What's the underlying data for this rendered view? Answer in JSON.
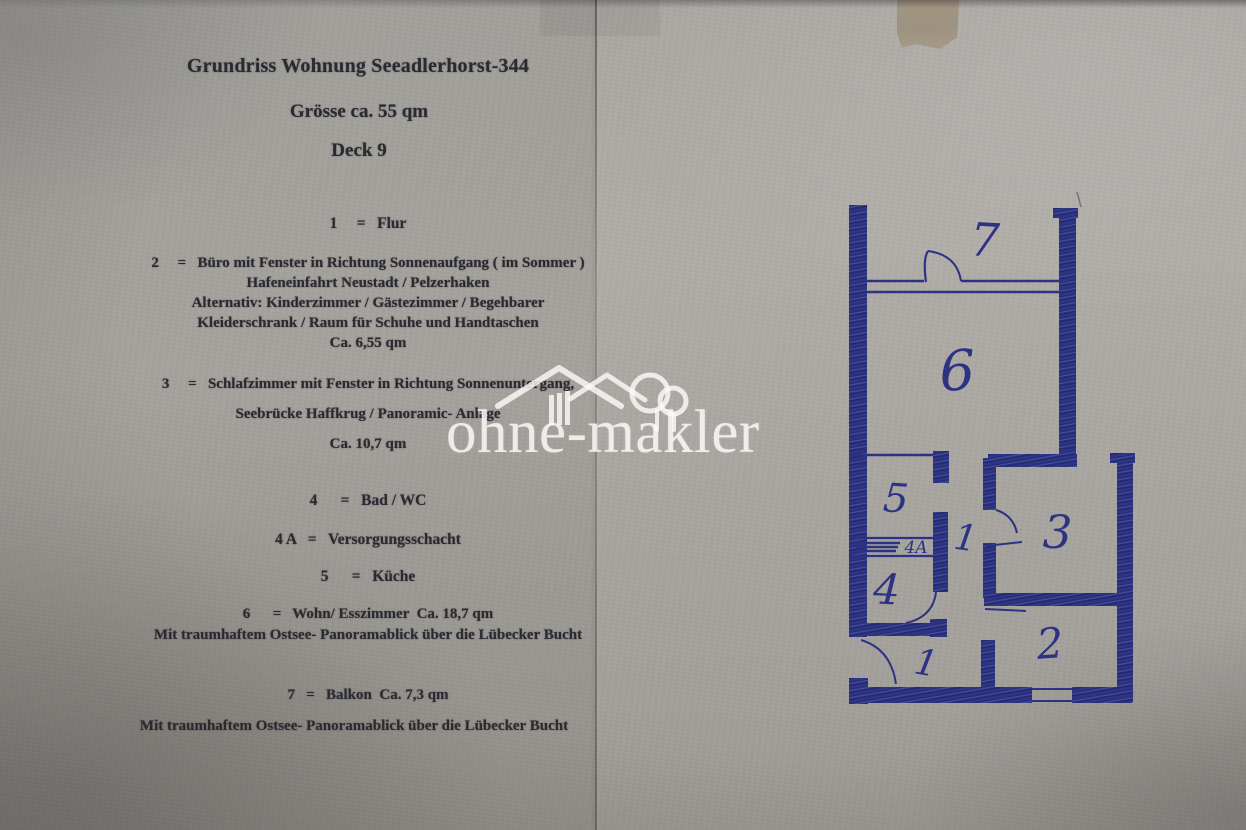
{
  "document": {
    "title": "Grundriss Wohnung Seeadlerhorst-344",
    "size": "Grösse ca. 55 qm",
    "deck": "Deck 9",
    "legend": [
      {
        "lines": [
          "1     =   Flur"
        ]
      },
      {
        "lines": [
          "2     =   Büro mit Fenster in Richtung Sonnenaufgang ( im Sommer )",
          "Hafeneinfahrt Neustadt / Pelzerhaken",
          "Alternativ: Kinderzimmer / Gästezimmer / Begehbarer",
          "Kleiderschrank / Raum für Schuhe und Handtaschen",
          "Ca. 6,55 qm"
        ]
      },
      {
        "lines": [
          "3     =   Schlafzimmer mit Fenster in Richtung Sonnenuntergang,",
          "Seebrücke Haffkrug / Panoramic- Anlage",
          "Ca. 10,7 qm"
        ]
      },
      {
        "lines": [
          "4      =   Bad / WC"
        ]
      },
      {
        "lines": [
          "4 A   =   Versorgungsschacht"
        ]
      },
      {
        "lines": [
          "5      =   Küche"
        ]
      },
      {
        "lines": [
          "6      =   Wohn/ Esszimmer  Ca. 18,7 qm",
          "Mit traumhaftem Ostsee- Panoramablick über die Lübecker Bucht"
        ]
      },
      {
        "lines": [
          "7   =   Balkon  Ca. 7,3 qm",
          "Mit traumhaftem Ostsee- Panoramablick über die Lübecker Bucht"
        ]
      }
    ]
  },
  "watermark": {
    "brand": "ohne-makler"
  },
  "floorplan": {
    "rooms": {
      "balcony": "7",
      "living": "6",
      "kitchen": "5",
      "shaft": "4A",
      "bath": "4",
      "bedroom": "3",
      "office": "2",
      "hall_mid": "1",
      "hall_entry": "1"
    }
  },
  "colors": {
    "ink_blue": "#2c3383",
    "paper_gray": "#a7a49f",
    "watermark_white": "#fbfaf7"
  }
}
